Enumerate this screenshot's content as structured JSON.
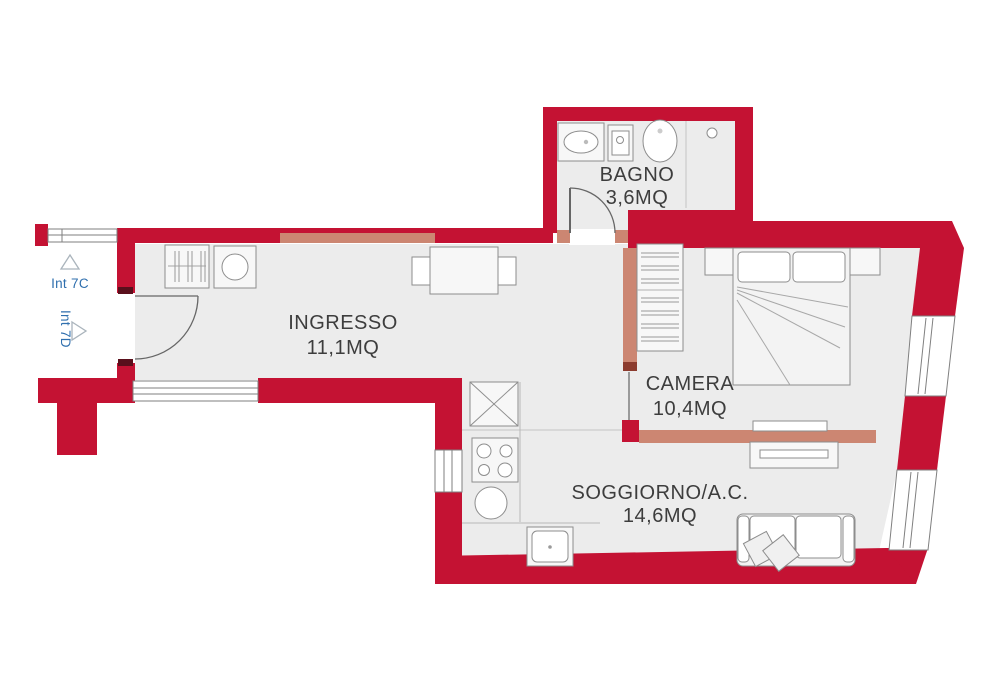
{
  "plan": {
    "type": "apartment-floor-plan",
    "rooms": [
      {
        "name": "BAGNO",
        "area": "3,6MQ"
      },
      {
        "name": "INGRESSO",
        "area": "11,1MQ"
      },
      {
        "name": "CAMERA",
        "area": "10,4MQ"
      },
      {
        "name": "SOGGIORNO/A.C.",
        "area": "14,6MQ"
      }
    ],
    "units": [
      {
        "label": "Int 7C",
        "arrow": "up"
      },
      {
        "label": "Int 7D",
        "arrow": "right"
      }
    ],
    "colors": {
      "wall": "#c41233",
      "new_partition": "#cc8672",
      "floor": "#ececec",
      "furniture_stroke": "#8d8d8d",
      "label_text": "#3d3d3d",
      "unit_text": "#2f6fae"
    }
  }
}
